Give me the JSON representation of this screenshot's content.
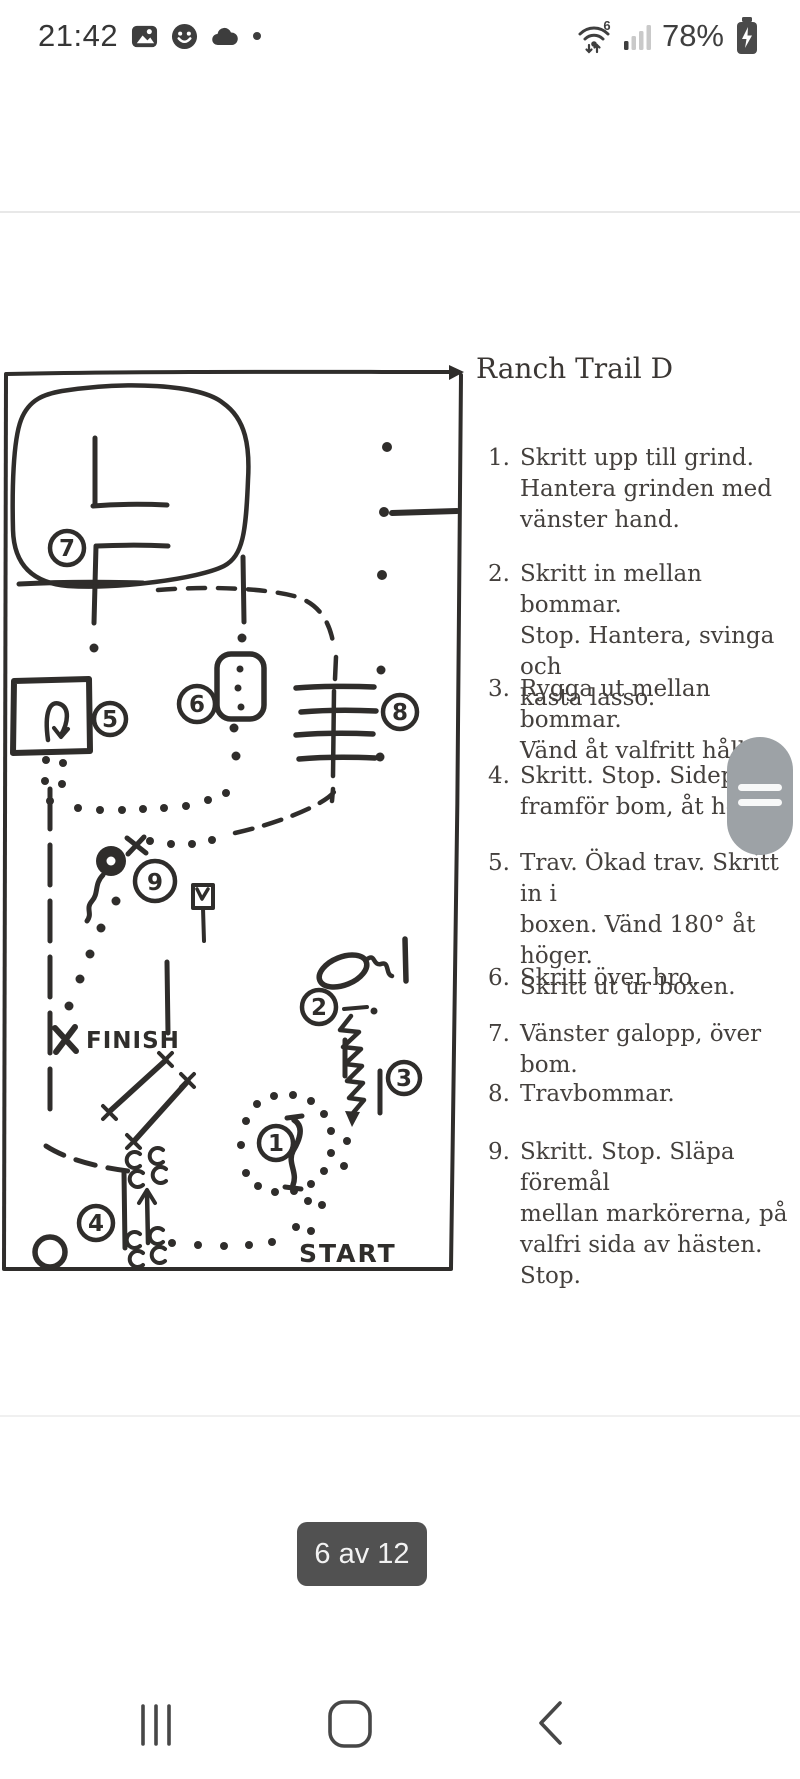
{
  "status_bar": {
    "time": "21:42",
    "notification_icons": [
      "image-icon",
      "smiley-icon",
      "cloud-icon",
      "dot-icon"
    ],
    "wifi_standard": "6",
    "battery_percent": "78%"
  },
  "document": {
    "title": "Ranch Trail D",
    "instructions": [
      {
        "num": "1.",
        "text": "Skritt upp till grind.\nHantera grinden med\nvänster hand."
      },
      {
        "num": "2.",
        "text": "Skritt in mellan bommar.\nStop. Hantera, svinga och\nkasta lasso."
      },
      {
        "num": "3.",
        "text": "Rygga ut mellan bommar.\nVänd åt valfritt håll."
      },
      {
        "num": "4.",
        "text": "Skritt. Stop. Sidepass\nframför bom, åt höger."
      },
      {
        "num": "5.",
        "text": "Trav. Ökad trav. Skritt in i\nboxen. Vänd 180° åt höger.\nSkritt ut ur boxen."
      },
      {
        "num": "6.",
        "text": "Skritt över bro."
      },
      {
        "num": "7.",
        "text": "Vänster galopp, över bom."
      },
      {
        "num": "8.",
        "text": "Travbommar."
      },
      {
        "num": "9.",
        "text": "Skritt. Stop. Släpa föremål\nmellan markörerna, på\nvalfri sida av hästen. Stop."
      }
    ],
    "diagram": {
      "start_label": "START",
      "finish_label": "FINISH",
      "obstacles": [
        "1",
        "2",
        "3",
        "4",
        "5",
        "6",
        "7",
        "8",
        "9"
      ]
    }
  },
  "pager": {
    "label": "6 av 12"
  },
  "nav_bar": {
    "recents_icon": "recents-icon",
    "home_icon": "home-icon",
    "back_icon": "back-icon"
  },
  "colors": {
    "ink": "#2f2d2b",
    "status_icon": "#3d3d3d",
    "pager_bg": "#515151",
    "scroll_handle": "#9da2a6",
    "divider": "#e8e8e8"
  }
}
